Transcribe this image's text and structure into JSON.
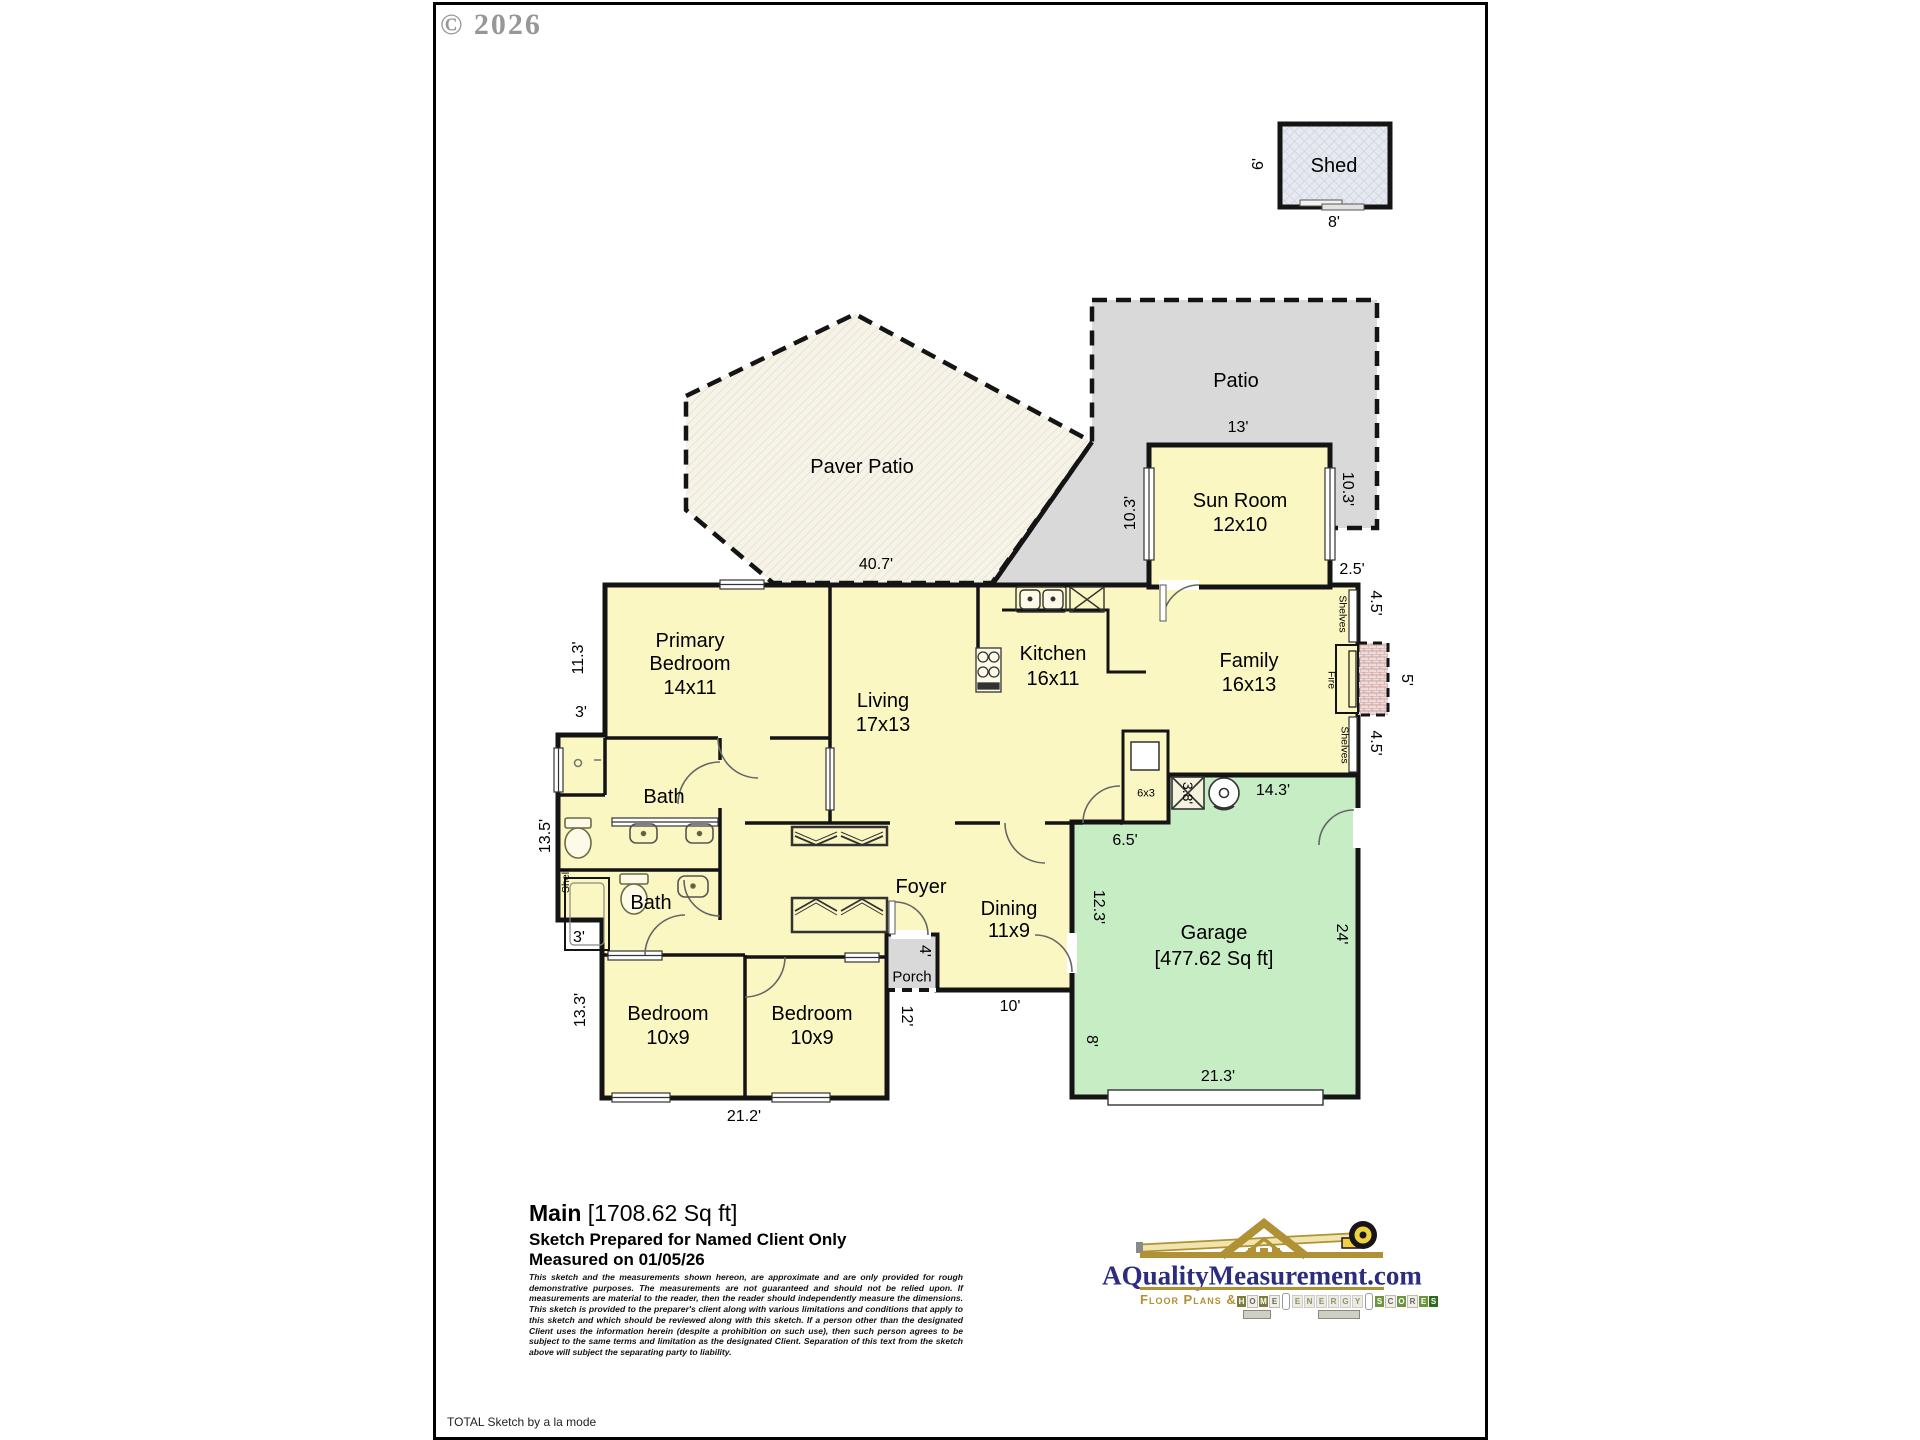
{
  "copyright": "© 2026",
  "footer": {
    "note": "TOTAL Sketch by a la mode"
  },
  "outdoor": {
    "paver_patio": "Paver Patio",
    "patio": "Patio",
    "porch": "Porch",
    "shed": "Shed"
  },
  "rooms": {
    "sun_room": {
      "name": "Sun Room",
      "size": "12x10"
    },
    "primary": {
      "line1": "Primary",
      "line2": "Bedroom",
      "size": "14x11"
    },
    "living": {
      "name": "Living",
      "size": "17x13"
    },
    "kitchen": {
      "name": "Kitchen",
      "size": "16x11"
    },
    "family": {
      "name": "Family",
      "size": "16x13"
    },
    "bath1": {
      "name": "Bath"
    },
    "bath2": {
      "name": "Bath"
    },
    "foyer": {
      "name": "Foyer"
    },
    "dining": {
      "name": "Dining",
      "size": "11x9"
    },
    "bedroom1": {
      "name": "Bedroom",
      "size": "10x9"
    },
    "bedroom2": {
      "name": "Bedroom",
      "size": "10x9"
    },
    "garage": {
      "name": "Garage",
      "size": "[477.62 Sq ft]"
    }
  },
  "fixtures": {
    "shelf": "Shelf",
    "shelves": "Shelves",
    "fire": "Fire",
    "utility_closet": "6x3"
  },
  "dims": {
    "shed_w": "8'",
    "shed_h": "6'",
    "paver": "40.7'",
    "patio_w": "13'",
    "sun_left": "10.3'",
    "sun_right": "10.3'",
    "jog": "2.5'",
    "shelves_top": "4.5'",
    "fire_w": "5'",
    "shelves_bottom": "4.5'",
    "left_top": "11.3'",
    "left_3a": "3'",
    "left_bath": "13.5'",
    "left_3b": "3'",
    "left_bottom": "13.3'",
    "bed_bottom": "21.2'",
    "porch_side": "12'",
    "front": "10'",
    "porch_depth": "4'",
    "garage_left": "12.3'",
    "garage_right": "24'",
    "garage_left_low": "8'",
    "garage_bottom": "21.3'",
    "garage_top": "14.3'",
    "kitchen_side": "6.5'",
    "water_heater": "3.8'"
  },
  "summary": {
    "main_label": "Main",
    "main_sqft": "[1708.62 Sq ft]",
    "prepared": "Sketch Prepared for Named Client Only",
    "measured": "Measured on 01/05/26",
    "disclaimer": "This sketch and the measurements shown hereon, are approximate and are only provided for rough demonstrative purposes. The measurements are not guaranteed and should not be relied upon. If measurements are material to the reader, then the reader should independently measure the dimensions. This sketch is provided to the preparer's client along with various limitations and conditions that apply to this sketch and which should be reviewed along with this sketch. If a person other than the designated Client uses the information herein (despite a prohibition on such use), then such person agrees to be subject to the same terms and limitation as the designated Client. Separation of this text from the sketch above will subject the separating party to liability."
  },
  "logo": {
    "site": "AQualityMeasurement.com",
    "tagline": "Floor Plans &",
    "tiles": [
      {
        "ch": "H",
        "k": "olive"
      },
      {
        "ch": "O",
        "k": "light"
      },
      {
        "ch": "M",
        "k": "olive"
      },
      {
        "ch": "E",
        "k": "light"
      },
      {
        "ch": "",
        "k": "therm"
      },
      {
        "ch": "E",
        "k": "gray"
      },
      {
        "ch": "N",
        "k": "gray"
      },
      {
        "ch": "E",
        "k": "gray"
      },
      {
        "ch": "R",
        "k": "gray"
      },
      {
        "ch": "G",
        "k": "gray"
      },
      {
        "ch": "Y",
        "k": "gray"
      },
      {
        "ch": "",
        "k": "therm"
      },
      {
        "ch": "S",
        "k": "green"
      },
      {
        "ch": "C",
        "k": "light"
      },
      {
        "ch": "O",
        "k": "green"
      },
      {
        "ch": "R",
        "k": "light"
      },
      {
        "ch": "E",
        "k": "green"
      },
      {
        "ch": "S",
        "k": "dark"
      }
    ]
  },
  "colors": {
    "room_yellow": "#fbf7c2",
    "garage_green": "#c7edc4",
    "patio_gray": "#d9d9d9",
    "paver_cream": "#f6f3e9",
    "shed_gray": "#e6e9f0",
    "wall": "#141414",
    "logo_gold": "#b09136",
    "logo_navy": "#2c2c80"
  }
}
